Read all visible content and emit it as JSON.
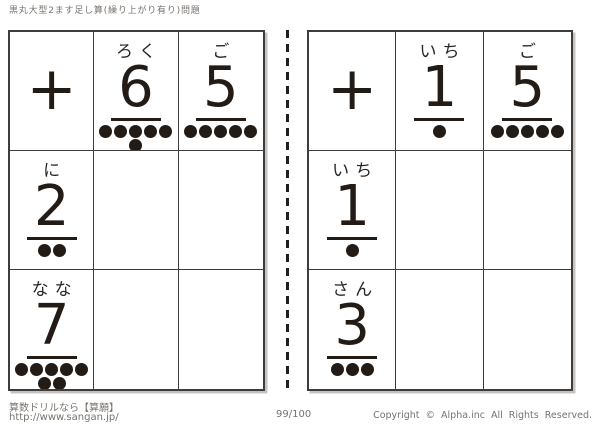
{
  "page": {
    "title": "黒丸大型2ます足し算(繰り上がり有り)問題"
  },
  "colors": {
    "ink": "#231b16",
    "grid_line": "#3d3d3d",
    "muted_text": "#78736e"
  },
  "worksheets": [
    {
      "operator": "+",
      "column_headers": [
        {
          "reading": "ろく",
          "digit": "6",
          "dot_rows": [
            5,
            1
          ]
        },
        {
          "reading": "ご",
          "digit": "5",
          "dot_rows": [
            5
          ]
        }
      ],
      "row_headers": [
        {
          "reading": "に",
          "digit": "2",
          "dot_rows": [
            2
          ]
        },
        {
          "reading": "なな",
          "digit": "7",
          "dot_rows": [
            5,
            2
          ]
        }
      ]
    },
    {
      "operator": "+",
      "column_headers": [
        {
          "reading": "いち",
          "digit": "1",
          "dot_rows": [
            1
          ]
        },
        {
          "reading": "ご",
          "digit": "5",
          "dot_rows": [
            5
          ]
        }
      ],
      "row_headers": [
        {
          "reading": "いち",
          "digit": "1",
          "dot_rows": [
            1
          ]
        },
        {
          "reading": "さん",
          "digit": "3",
          "dot_rows": [
            3
          ]
        }
      ]
    }
  ],
  "footer": {
    "site_label": "算数ドリルなら【算願】",
    "site_url": "http://www.sangan.jp/",
    "page_number": "99/100",
    "copyright": "Copyright © Alpha.inc All Rights Reserved."
  }
}
